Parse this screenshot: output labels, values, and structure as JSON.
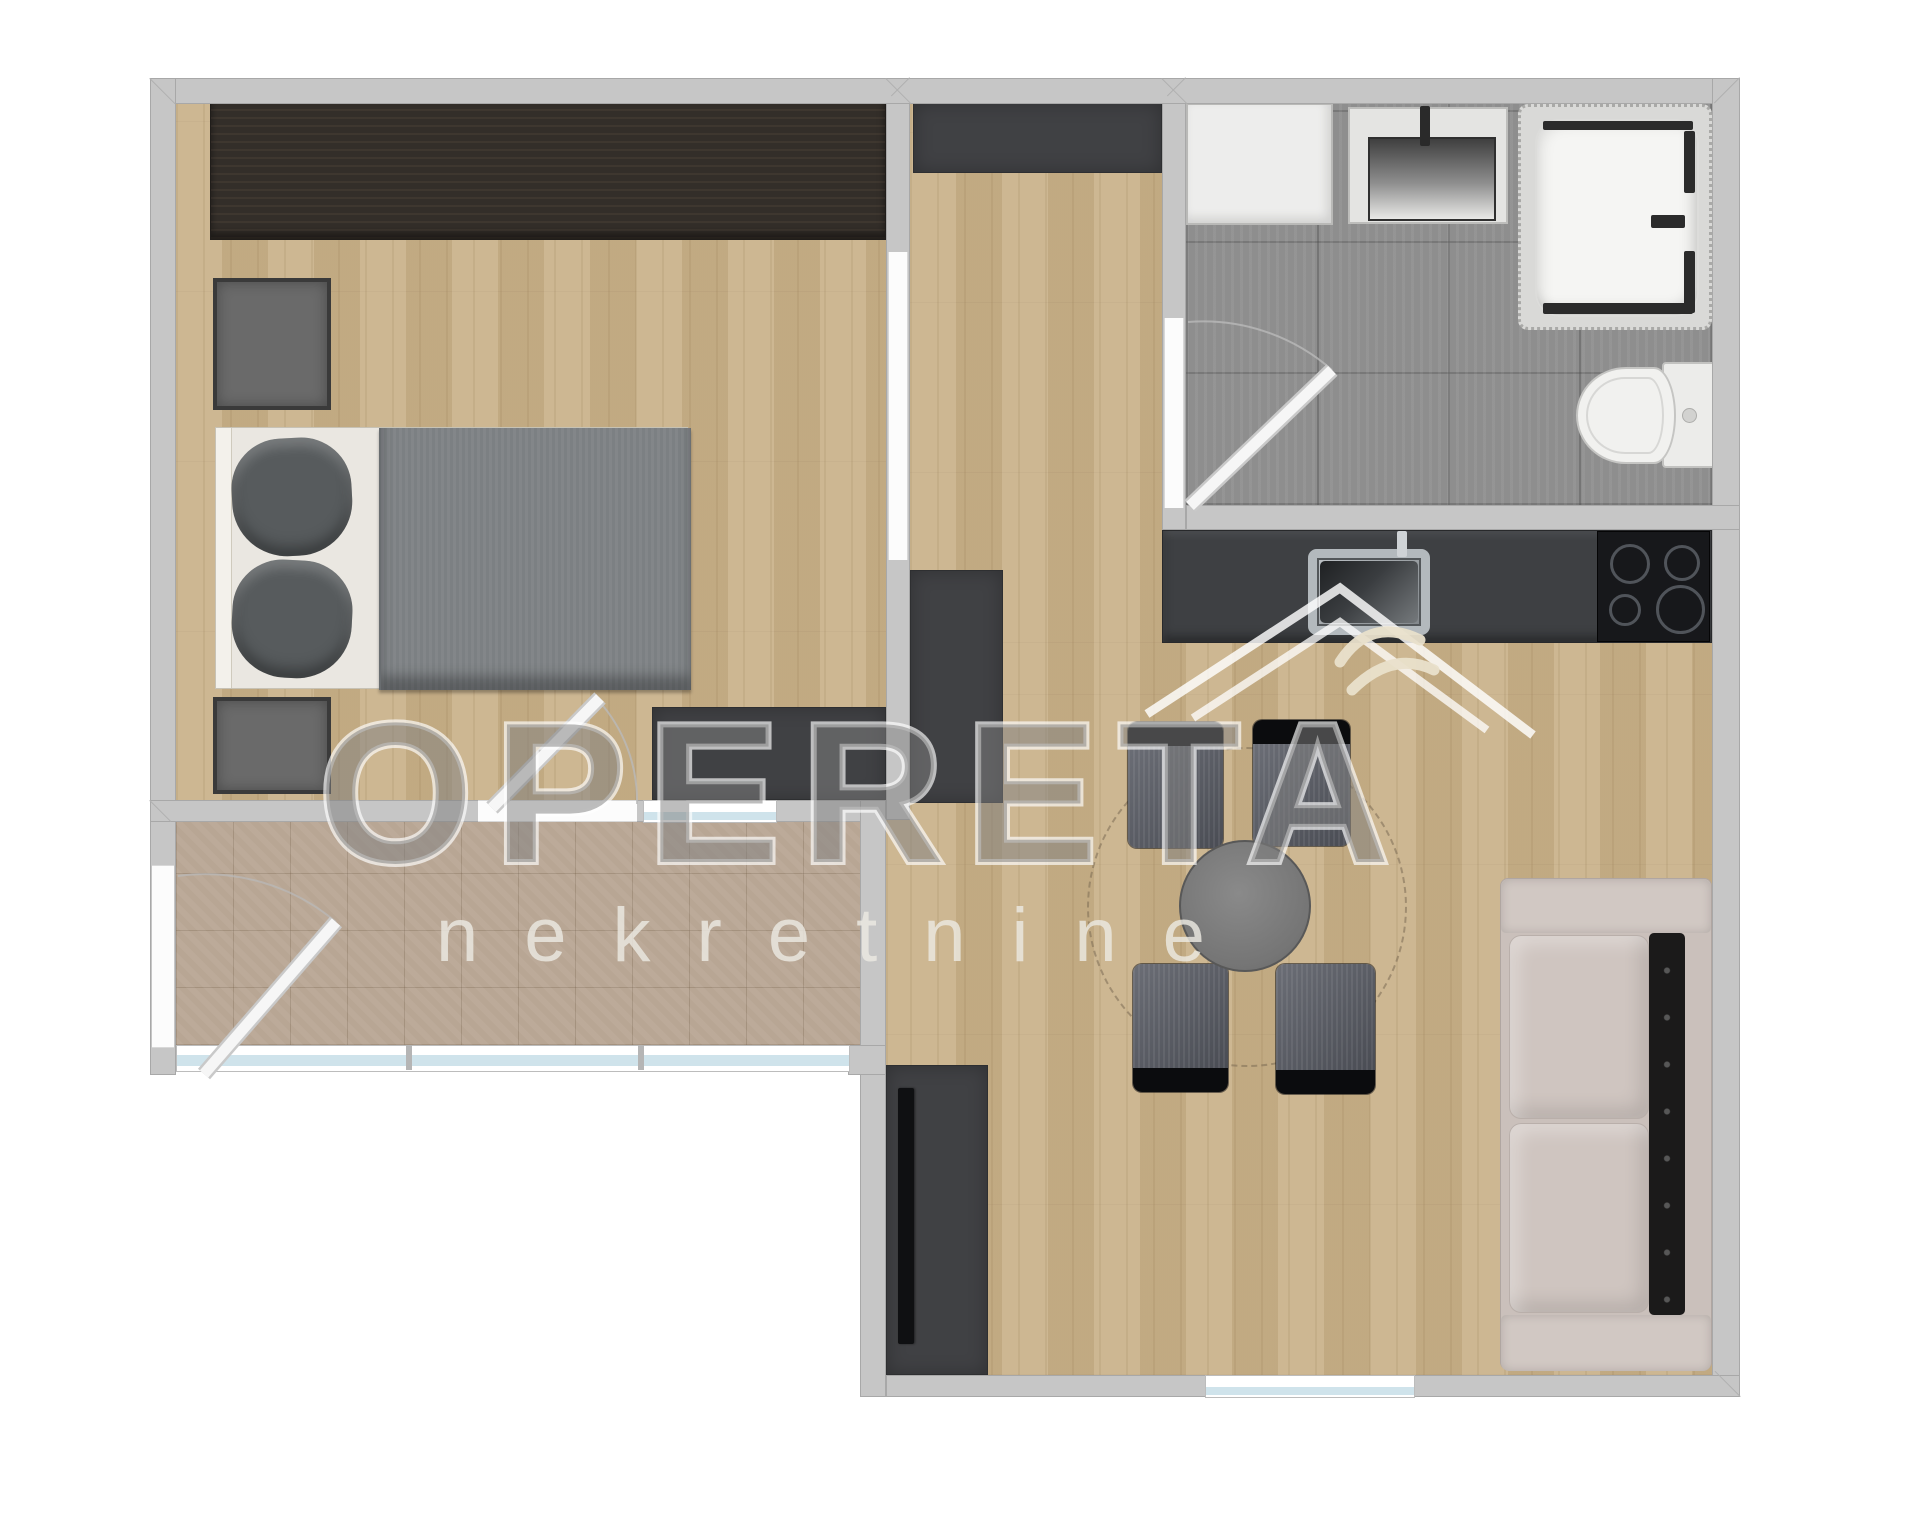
{
  "watermark": {
    "brand": "OPERETA",
    "subtitle": "nekretnine",
    "logo": "roof-with-swallow-icon"
  },
  "palette": {
    "background": "#ffffff",
    "wall_gray": "#c6c6c6",
    "wood_floor": "#c9b189",
    "balcony_tile": "#b8a694",
    "bathroom_tile": "#8e8e8e",
    "dark_furniture": "#3f4043",
    "wardrobe_wood": "#332e29",
    "bed_blanket": "#7c8083",
    "pillow_gray": "#575b5d",
    "sofa_beige": "#cac0bb",
    "sofa_backrest": "#1b1a1a",
    "chair_fabric": "#5a5d66",
    "cooktop_black": "#17181b",
    "window_glass": "#cfe3eb",
    "watermark_fill": "#8a8a8a",
    "watermark_stroke": "#ffffff"
  },
  "plan": {
    "type": "apartment-floor-plan-top-view",
    "rooms": [
      {
        "name": "bedroom"
      },
      {
        "name": "hallway"
      },
      {
        "name": "bathroom"
      },
      {
        "name": "kitchen"
      },
      {
        "name": "living-dining-area"
      },
      {
        "name": "balcony"
      }
    ],
    "furniture": [
      "wardrobe",
      "bed",
      "pillows",
      "nightstand",
      "dresser",
      "hall-closet",
      "washing-machine",
      "washbasin-vanity",
      "shower-cabin",
      "toilet",
      "kitchen-counter",
      "kitchen-sink",
      "cooktop",
      "dining-table",
      "dining-chairs",
      "round-rug",
      "sofa",
      "tv-stand",
      "tv",
      "doors",
      "windows"
    ]
  }
}
